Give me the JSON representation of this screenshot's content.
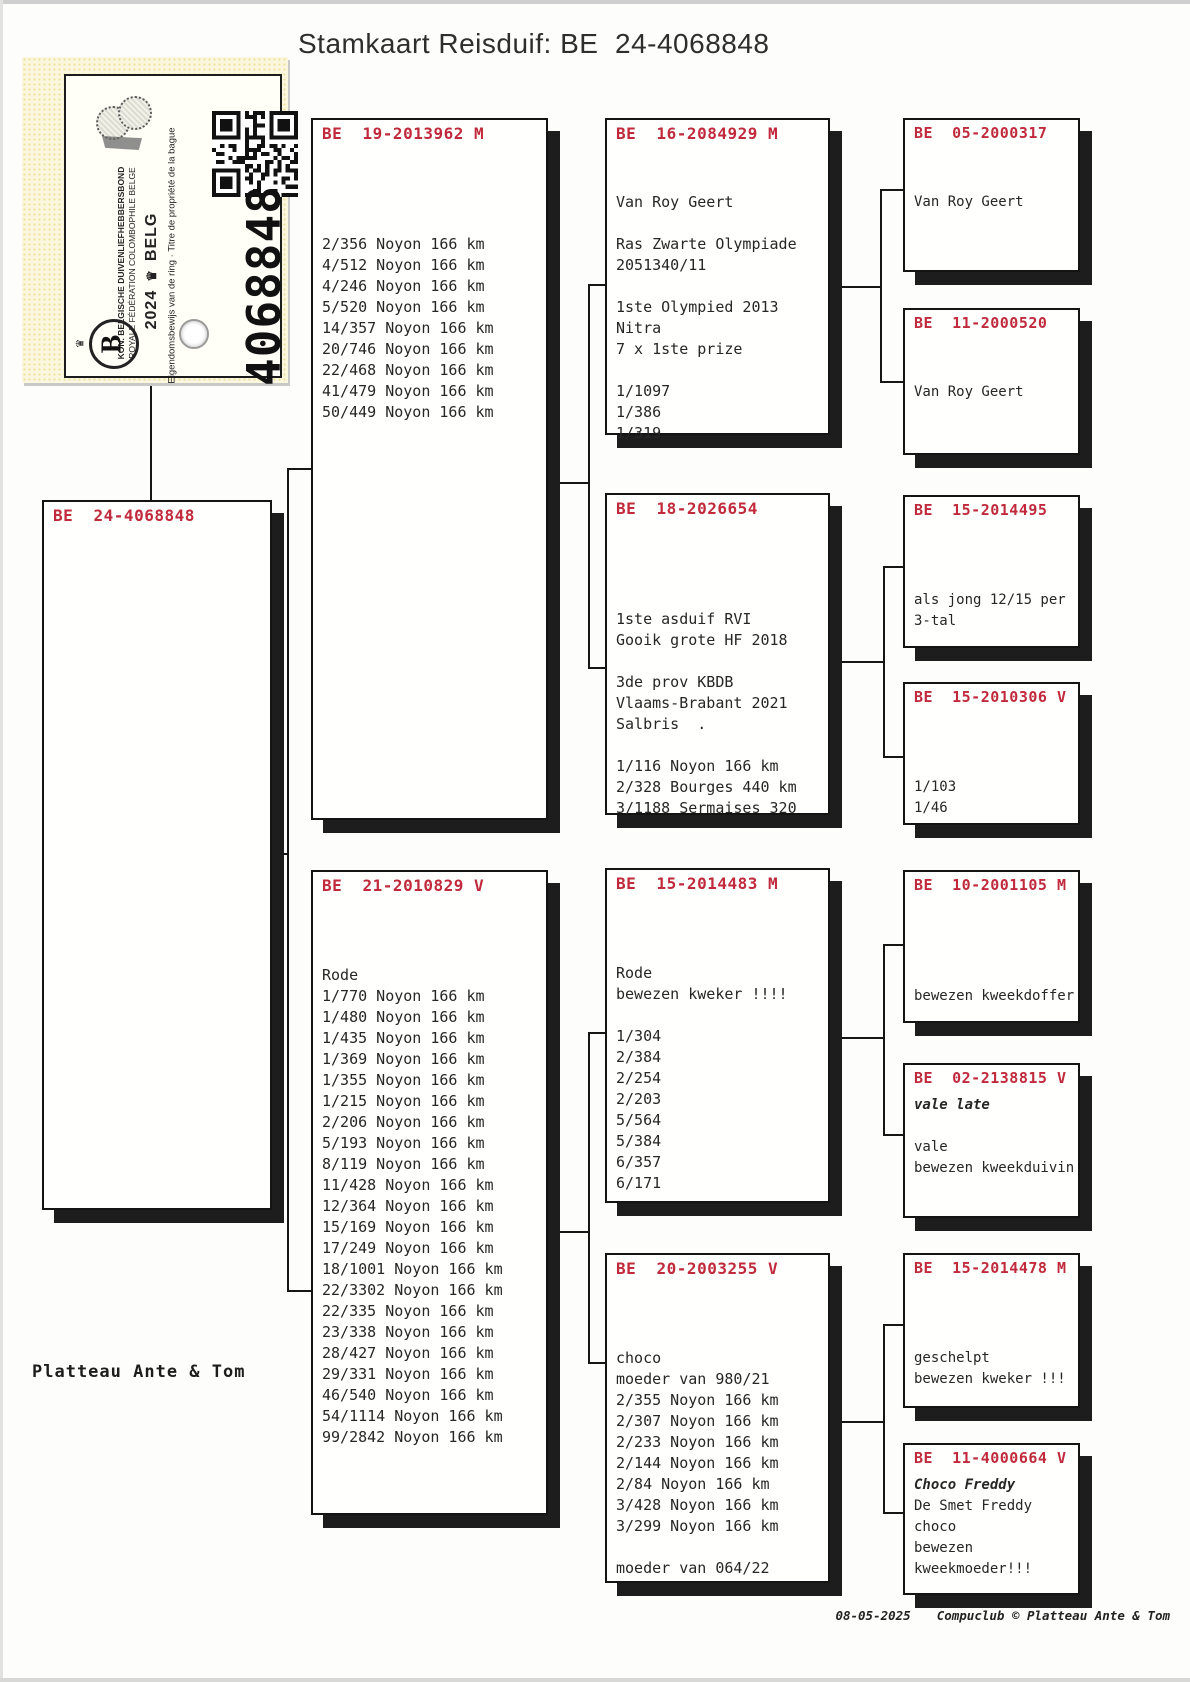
{
  "title": "Stamkaart Reisduif: BE  24-4068848",
  "certificate": {
    "federation_line1": "KON. BELGISCHE DUIVENLIEFHEBBERSBOND",
    "federation_line2": "ROYALE FÉDÉRATION COLOMBOPHILE BELGE",
    "year": "2024",
    "country": "BELG",
    "crown_icon": "♛",
    "ownership_line": "Eigendomsbewijs van de ring · Titre de propriété de la bague",
    "ring_number": "4068848",
    "logo_letter": "B"
  },
  "boxes": [
    {
      "id": "subject",
      "ring": "BE  24-4068848",
      "lines": [],
      "italic": []
    },
    {
      "id": "father",
      "ring": "BE  19-2013962 M",
      "italic": [],
      "lines": [
        "",
        "",
        "",
        "",
        "2/356 Noyon 166 km",
        "4/512 Noyon 166 km",
        "4/246 Noyon 166 km",
        "5/520 Noyon 166 km",
        "14/357 Noyon 166 km",
        "20/746 Noyon 166 km",
        "22/468 Noyon 166 km",
        "41/479 Noyon 166 km",
        "50/449 Noyon 166 km"
      ]
    },
    {
      "id": "mother",
      "ring": "BE  21-2010829 V",
      "italic": [],
      "lines": [
        "",
        "",
        "",
        "Rode",
        "1/770 Noyon 166 km",
        "1/480 Noyon 166 km",
        "1/435 Noyon 166 km",
        "1/369 Noyon 166 km",
        "1/355 Noyon 166 km",
        "1/215 Noyon 166 km",
        "2/206 Noyon 166 km",
        "5/193 Noyon 166 km",
        "8/119 Noyon 166 km",
        "11/428 Noyon 166 km",
        "12/364 Noyon 166 km",
        "15/169 Noyon 166 km",
        "17/249 Noyon 166 km",
        "18/1001 Noyon 166 km",
        "22/3302 Noyon 166 km",
        "22/335 Noyon 166 km",
        "23/338 Noyon 166 km",
        "28/427 Noyon 166 km",
        "29/331 Noyon 166 km",
        "46/540 Noyon 166 km",
        "54/1114 Noyon 166 km",
        "99/2842 Noyon 166 km"
      ]
    },
    {
      "id": "gp1",
      "ring": "BE  16-2084929 M",
      "italic": [],
      "lines": [
        "",
        "",
        "Van Roy Geert",
        "",
        "Ras Zwarte Olympiade",
        "2051340/11",
        "",
        "1ste Olympied 2013",
        "Nitra",
        "7 x 1ste prize",
        "",
        "1/1097",
        "1/386",
        "1/319"
      ]
    },
    {
      "id": "gp2",
      "ring": "BE  18-2026654",
      "italic": [],
      "lines": [
        "",
        "",
        "",
        "",
        "1ste asduif RVI",
        "Gooik grote HF 2018",
        "",
        "3de prov KBDB",
        "Vlaams-Brabant 2021",
        "Salbris  .",
        "",
        "1/116 Noyon 166 km",
        "2/328 Bourges 440 km",
        "3/1188 Sermaises 320"
      ]
    },
    {
      "id": "gp3",
      "ring": "BE  15-2014483 M",
      "italic": [],
      "lines": [
        "",
        "",
        "",
        "Rode",
        "bewezen kweker !!!!",
        "",
        "1/304",
        "2/384",
        "2/254",
        "2/203",
        "5/564",
        "5/384",
        "6/357",
        "6/171"
      ]
    },
    {
      "id": "gp4",
      "ring": "BE  20-2003255 V",
      "italic": [],
      "lines": [
        "",
        "",
        "",
        "choco",
        "moeder van 980/21",
        "2/355 Noyon 166 km",
        "2/307 Noyon 166 km",
        "2/233 Noyon 166 km",
        "2/144 Noyon 166 km",
        "2/84 Noyon 166 km",
        "3/428 Noyon 166 km",
        "3/299 Noyon 166 km",
        "",
        "moeder van 064/22"
      ]
    },
    {
      "id": "ggp1",
      "ring": "BE  05-2000317",
      "italic": [],
      "lines": [
        "",
        "",
        "Van Roy Geert"
      ]
    },
    {
      "id": "ggp2",
      "ring": "BE  11-2000520",
      "italic": [],
      "lines": [
        "",
        "",
        "Van Roy Geert"
      ]
    },
    {
      "id": "ggp3",
      "ring": "BE  15-2014495",
      "italic": [],
      "lines": [
        "",
        "",
        "",
        "als jong 12/15 per",
        "3-tal"
      ]
    },
    {
      "id": "ggp4",
      "ring": "BE  15-2010306 V",
      "italic": [],
      "lines": [
        "",
        "",
        "",
        "1/103",
        "1/46"
      ]
    },
    {
      "id": "ggp5",
      "ring": "BE  10-2001105 M",
      "italic": [],
      "lines": [
        "",
        "",
        "",
        "",
        "bewezen kweekdoffer"
      ]
    },
    {
      "id": "ggp6",
      "ring": "BE  02-2138815 V",
      "italic": [
        0
      ],
      "lines": [
        "vale late",
        "",
        "vale",
        "bewezen kweekduivin"
      ]
    },
    {
      "id": "ggp7",
      "ring": "BE  15-2014478 M",
      "italic": [],
      "lines": [
        "",
        "",
        "",
        "geschelpt",
        "bewezen kweker !!!"
      ]
    },
    {
      "id": "ggp8",
      "ring": "BE  11-4000664 V",
      "italic": [
        0
      ],
      "lines": [
        "Choco Freddy",
        "De Smet Freddy",
        "choco",
        "bewezen",
        "kweekmoeder!!!"
      ]
    }
  ],
  "owner": "Platteau Ante & Tom",
  "footer": {
    "date": "08-05-2025",
    "credit": "Compuclub © Platteau Ante & Tom"
  }
}
